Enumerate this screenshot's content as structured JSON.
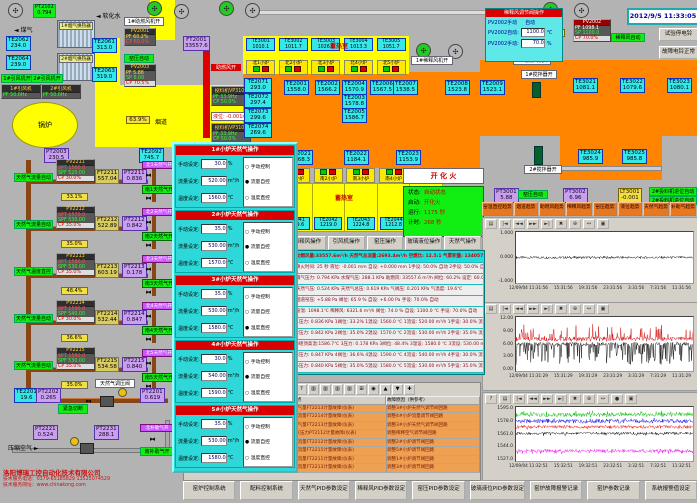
{
  "header": {
    "datetime": "2012/9/5 11:33:05"
  },
  "topLeft": {
    "gas": "煤气",
    "water": "软化水",
    "pt2102": [
      "PT2102",
      "0.794"
    ],
    "hx1": "1#烟气换热器",
    "hx2": "2#烟气换热器",
    "te2062": [
      "TE2062",
      "234.0"
    ],
    "te2061": [
      "TE2061",
      "313.0"
    ],
    "te2064": [
      "TE2064",
      "239.0"
    ],
    "te2063": [
      "TE2063",
      "319.0"
    ],
    "fan1open": "1#引风机开",
    "fan2open": "2#引风机开",
    "fan1name": "1#引风机",
    "fan1pf": "PF 50.0Hz",
    "fan2name": "2#引风机",
    "fan2pf": "PF 50.0Hz",
    "boiler": "锅炉",
    "flue": "烟道",
    "damper": "63.9%",
    "pt2003": [
      "PT2003",
      "230.5"
    ],
    "te2092": [
      "TE2092",
      "745.7"
    ],
    "ft2001": [
      "FT2001",
      "33557.6"
    ],
    "pv2001": {
      "tag": "PV2001",
      "r1": "PF 60.2%",
      "r2": "CP 60.0%"
    },
    "pv2003": {
      "tag": "PV2003",
      "r1": "PF 5.88",
      "r2": "SP 6.00",
      "r3": "CP 70.5%"
    },
    "yapAuto": "窑压自动",
    "combFan1": "1#助燃风机开",
    "combAirOpen": "助燃风开",
    "feeder1": {
      "tag": "投料机VP3101",
      "r1": "PF 33.9Hz",
      "r2": "CP 50.0%"
    },
    "feeder2": {
      "tag": "投料机VP3102",
      "r1": "PF 33.9Hz",
      "r2": "CP 50.0%"
    },
    "level": "液位: -0.001mm"
  },
  "north": {
    "label": "蓄热室",
    "chambers": [
      {
        "te": "TE3001",
        "v": "1010.1",
        "burner": "北1小炉"
      },
      {
        "te": "TE3002",
        "v": "1011.7",
        "burner": "北2小炉"
      },
      {
        "te": "TE3003",
        "v": "1026.1",
        "burner": "北3小炉"
      },
      {
        "te": "TE3004",
        "v": "1013.3",
        "burner": "北4小炉"
      },
      {
        "te": "TE3005",
        "v": "1051.7",
        "burner": "北5小炉"
      }
    ]
  },
  "south": {
    "label": "蓄热室",
    "chambers": [
      {
        "burner": "南1小炉",
        "te": "TE2041",
        "v": "1209.6"
      },
      {
        "burner": "南2小炉",
        "te": "TE2042",
        "v": "1219.0"
      },
      {
        "burner": "南3小炉",
        "te": "TE2043",
        "v": "1224.8"
      },
      {
        "burner": "南4小炉",
        "te": "TE2044",
        "v": "1212.8"
      },
      {
        "burner": "南5小炉",
        "te": "TE2045",
        "v": "1211.0"
      }
    ]
  },
  "furnaceTemps": {
    "te2071": [
      "TE2071",
      "293.0"
    ],
    "te2072": [
      "TE2072",
      "297.4"
    ],
    "te2073": [
      "TE2073",
      "299.6"
    ],
    "te2074": [
      "TE2074",
      "269.6"
    ],
    "te2001": [
      "TE2001",
      "1558.0"
    ],
    "te2002": [
      "TE2002",
      "1566.2"
    ],
    "te2003": [
      "TE2003",
      "1578.8"
    ],
    "te2004": [
      "TE2004",
      "1570.9"
    ],
    "te2005": [
      "TE2005",
      "1586.7"
    ],
    "te2006": [
      "TE2006",
      "1567.5"
    ],
    "te2007": [
      "TE2007",
      "1538.5"
    ],
    "te2008": [
      "TE2008",
      "1523.8"
    ],
    "te2009": [
      "TE2009",
      "1523.1"
    ],
    "te3021": [
      "TE3021",
      "1081.1"
    ],
    "te3022": [
      "TE3022",
      "1079.6"
    ],
    "te3023": [
      "TE3023",
      "1080.1"
    ],
    "te3024": [
      "TE3024",
      "985.9"
    ],
    "te3025": [
      "TE3025",
      "985.8"
    ],
    "te2021": [
      "TE2021",
      "1168.3"
    ],
    "te2022": [
      "TE2022",
      "1184.1"
    ],
    "te2023": [
      "TE2023",
      "1153.9"
    ]
  },
  "rightSide": {
    "dilPanel": {
      "title": "稀释风调节阀操作",
      "modeL": "PV2002手动",
      "modeR": "自动",
      "autoL": "PV2002自动:",
      "autoV": "1100.0",
      "autoU": "℃",
      "manL": "PV2002手动:",
      "manV": "70.0",
      "manU": "%"
    },
    "pct74": "74.0%",
    "pt2002": [
      "PT2002",
      "6321.6"
    ],
    "pv2002": {
      "tag": "PV2002",
      "r1": "PF 1098.1",
      "r2": "SP 1100.0",
      "r3": "CP 70.0%"
    },
    "dilAuto": "稀释风自动",
    "btnTest": "试验停电铃",
    "btnBell": "故障电铃正常",
    "dilFan1": "1#稀释风机开",
    "combFan2": "2#助燃风机开",
    "stir1": "1#搅拌器开",
    "stir2": "2#搅拌器开",
    "pt3001": [
      "PT3001",
      "5.88"
    ],
    "yapAuto2": "窑压自动",
    "pt3002": [
      "PT3002",
      "6.96"
    ],
    "lt3001": [
      "LT3001",
      "-0.001"
    ],
    "feederAuto1": "2#投料机进位自动",
    "feederAuto2": "2#投料机进位自动"
  },
  "ignition": "开 化 火",
  "status": {
    "rows": [
      {
        "k": "状态:",
        "v": "自动状态"
      },
      {
        "k": "启动:",
        "v": "开化火"
      },
      {
        "k": "运行:",
        "v": "1175 秒"
      },
      {
        "k": "计时:",
        "v": "268 秒"
      }
    ]
  },
  "opButtons": [
    "稀释风操作",
    "引风机操作",
    "窑压操作",
    "玻璃液位操作",
    "天然气操作"
  ],
  "trendButtons": [
    "窑温直控趋势",
    "烟道趋势",
    "助燃风趋势",
    "稀释风趋势",
    "窑压趋势",
    "液位趋势",
    "天然气趋势",
    "补助气趋势"
  ],
  "gasLoops": [
    {
      "auto": "天然气流量自动",
      "tag": "PV2211",
      "spt": "SPT 1560.0",
      "spf": "SPF 520.00",
      "cp": "CP 30.0%",
      "ft": "FT2211",
      "ftv": "557.04",
      "pt": "PT2211",
      "ptv": "0.836",
      "pct": "33.1%",
      "vN": "北1天然气开",
      "vS": "南1天然气开"
    },
    {
      "auto": "天然气流量自动",
      "tag": "PV2212",
      "spt": "SPT 1570.0",
      "spf": "SPF 530.00",
      "cp": "CP 35.0%",
      "ft": "FT2212",
      "ftv": "522.89",
      "pt": "PT2212",
      "ptv": "0.842",
      "pct": "35.0%",
      "vN": "北2天然气开",
      "vS": "南2天然气开"
    },
    {
      "auto": "天然气温度直控",
      "tag": "PV2213",
      "spt": "SPT 1580.0",
      "spf": "SPF 530.00",
      "cp": "CP 35.0%",
      "ft": "FT2213",
      "ftv": "603.19",
      "pt": "PT2213",
      "ptv": "0.178",
      "pct": "48.4%",
      "vN": "北3天然气开",
      "vS": "南3天然气开"
    },
    {
      "auto": "天然气流量自动",
      "tag": "PV2214",
      "spt": "SPT 1590.0",
      "spf": "SPF 540.00",
      "cp": "CP 30.0%",
      "ft": "FT2214",
      "ftv": "532.44",
      "pt": "PT2214",
      "ptv": "0.847",
      "pct": "36.6%",
      "vN": "北4天然气开",
      "vS": "南4天然气开"
    },
    {
      "auto": "天然气流量自动",
      "tag": "PV2215",
      "spt": "SPT 1580.0",
      "spf": "SPF 530.00",
      "cp": "CP 35.0%",
      "ft": "FT2215",
      "ftv": "534.58",
      "pt": "PT2215",
      "ptv": "0.840",
      "pct": "35.0%",
      "vN": "北5天然气开",
      "vS": "南5天然气开"
    }
  ],
  "bottomLeft": {
    "te2201": [
      "TE2201",
      "19.6"
    ],
    "pt2202": [
      "PT2202",
      "0.265"
    ],
    "btnCut": "紧急切断",
    "valveLabel": "天然气调压阀",
    "pt2201": [
      "PT2201",
      "0.619"
    ],
    "vN": "北补助气开",
    "vS": "南补助气开",
    "pt2221": [
      "PT2221",
      "0.524"
    ],
    "pt2231": [
      "PT2231",
      "288.1"
    ],
    "air": "压缩空气"
  },
  "popup": {
    "labels": {
      "manual": "手动设定:",
      "flow": "流量设定:",
      "temp": "温度设定:",
      "uM": "%",
      "uF": "m³/h",
      "uT": "℃",
      "rManual": "手动控制",
      "rFlow": "流量自控",
      "rTemp": "温度直控"
    },
    "sections": [
      {
        "title": "1#小炉天然气操作",
        "manual": "30.0",
        "flow": "520.00",
        "temp": "1560.0",
        "r1": "○",
        "r2": "●",
        "r3": "○"
      },
      {
        "title": "2#小炉天然气操作",
        "manual": "35.0",
        "flow": "530.00",
        "temp": "1570.0",
        "r1": "○",
        "r2": "●",
        "r3": "○"
      },
      {
        "title": "3#小炉天然气操作",
        "manual": "35.0",
        "flow": "530.00",
        "temp": "1580.0",
        "r1": "○",
        "r2": "○",
        "r3": "●"
      },
      {
        "title": "4#小炉天然气操作",
        "manual": "30.0",
        "flow": "540.00",
        "temp": "1590.0",
        "r1": "○",
        "r2": "●",
        "r3": "○"
      },
      {
        "title": "5#小炉天然气操作",
        "manual": "35.0",
        "flow": "530.00",
        "temp": "1580.0",
        "r1": "○",
        "r2": "●",
        "r3": "○"
      }
    ]
  },
  "params": {
    "rows": [
      "助燃风量:33557.6m³/h  天然气总流量:2693.4m³/h  空燃比: 12.5:1  气累积量: 134057.7m³",
      "换火时间: 25 秒   液位: -0.001 mm  自设: +0.000 mm  1手设: 50.0% 自动  2手设: 50.0% 自动",
      "煤气压力: 0.794 KPa  水煤气压: 288.1 KPa  助燃风: 33557.6 m³/h  阀位: 60.2%  设定: 60.0%",
      "天然气压: 0.524 KPa  天然气总压: 0.619 KPa  气阀压: 0.201 KPa  气温度: 19.6℃",
      "烟道窑压: +5.88 Pa  阀位: 65.9 %  自设: +6.00 Pa  手设: 70.0%  自动",
      "窑温: 1098.1℃  稀释风: 6321.6 m³/h  阀位: 74.0 %  自设: 1100.0 ℃  手设: 70.0%  自动",
      "1压力: 0.836 KPa  1阀位: 33.2%  1温设: 1560.0 ℃  1流设: 520.00 m³/h  1手设: 30.0%  流控",
      "2压力: 0.842 KPa  2阀位: 35.0%  2温设: 1570.0 ℃  2流设: 530.00 m³/h  2手设: 35.0%  流控",
      "3碹顶高温:1586.7℃  3压力: 0.178 KPa  3阀位: 48.4%  3温设: 1580.0 ℃  3流设: 530.00 m³/h  3手设: 35.0%  温控",
      "4压力: 0.847 KPa  4阀位: 36.6%  4温设: 1590.0 ℃  4流设: 540.00 m³/h  4手设: 30.0%  流控",
      "5压力: 0.840 KPa  5阀位: 35.0%  5温设: 1580.0 ℃  5流设: 530.00 m³/h  5手设: 35.0%  流控"
    ]
  },
  "log": {
    "toolbar": [
      "≣",
      "?",
      "▥",
      "▥",
      "▥",
      "▥",
      "⊞",
      "◉",
      "▲",
      "▼",
      "✚"
    ],
    "hFault": "故障点",
    "hReason": "故障原因（供参考）",
    "rows": [
      [
        "",
        "16",
        "98",
        "2012/09/05",
        "11:17:20",
        "3#小炉气量FT2213计量故障(仪表)",
        "调整3#小炉天然气调节阀回路"
      ],
      [
        "",
        "17",
        "84",
        "2012/09/05",
        "11:17:23",
        "4#小炉流量FT2214计量故障(仪表)",
        "调整4#小炉流量调节阀回路"
      ],
      [
        "",
        "18",
        "97",
        "2012/09/05",
        "11:17:26",
        "3#小炉气量FT2213计量故障(仪表)",
        "调整3#小炉天然气调节阀回路"
      ],
      [
        "",
        "19",
        "75",
        "2012/09/05",
        "11:17:30",
        "稀释空气压力PT2112计量故障(仪表)",
        "调整稀释空气调节阀回路"
      ],
      [
        "",
        "20",
        "82",
        "2012/09/05",
        "11:17:33",
        "2#小炉流量FT2212计量故障(仪表)",
        "调整2#小炉调节阀回路"
      ],
      [
        "",
        "21",
        "85",
        "2012/09/05",
        "11:17:33",
        "5#小炉流量FT2215计量故障(仪表)",
        "调整5#小炉调节阀回路"
      ],
      [
        "",
        "22",
        "81",
        "2012/09/05",
        "11:17:33",
        "1#小炉流量FT2211计量故障(仪表)",
        "调整1#小炉调节阀回路"
      ],
      [
        "▶",
        "23",
        "83",
        "2012/09/05",
        "11:17:33",
        "3#小炉流量FT2213计量故障(仪表)",
        "调整3#小炉调节阀回路"
      ]
    ]
  },
  "charts": {
    "toolbar": [
      "▤",
      "|◄",
      "◄◄",
      "►►",
      "►|",
      "✖",
      "⊕",
      "↔",
      "▣"
    ],
    "toolbar3": [
      "?",
      "▤",
      "|◄",
      "◄◄",
      "►►",
      "►|",
      "✖",
      "⊕",
      "↔",
      "●",
      "▣"
    ]
  },
  "chart_data": [
    {
      "type": "line",
      "title": "液位趋势",
      "yTicks": [
        "1.000",
        "0.000",
        "-1.000"
      ],
      "ymin": -1,
      "ymax": 1,
      "xTicks": [
        "12/09/04 11:31:56",
        "15:31:56",
        "19:31:56",
        "23:31:56",
        "3:31:56",
        "7:31:56",
        "11:31:56"
      ],
      "series": [
        {
          "name": "液位 mm",
          "color": "#000000",
          "base": 0,
          "amp": 0.05,
          "p": 0,
          "spike": 0,
          "sdir": 1
        }
      ]
    },
    {
      "type": "line",
      "title": "窑压趋势",
      "yTicks": [
        "12.00",
        "9.00",
        "6.00",
        "3.00",
        "0.00"
      ],
      "ymin": 0,
      "ymax": 12,
      "xTicks": [
        "12/09/04 11:31:29",
        "15:31:29",
        "19:31:29",
        "23:31:29",
        "3:31:29",
        "7:31:29",
        "11:31:29"
      ],
      "series": [
        {
          "name": "窑压设定 Pa",
          "color": "#cc0000",
          "base": 7.1,
          "amp": 0.5,
          "p": 0.18,
          "spike": 3.0,
          "sdir": 1
        },
        {
          "name": "窑压 Pa",
          "color": "#000000",
          "base": 6.0,
          "amp": 0.4,
          "p": 0.28,
          "spike": 4.5,
          "sdir": -1
        }
      ]
    },
    {
      "type": "line",
      "title": "窑温趋势",
      "yTicks": [
        "1595.0",
        "1578.0",
        "1561.0",
        "1544.0",
        "1527.0"
      ],
      "ymin": 1527,
      "ymax": 1595,
      "xTicks": [
        "12/09/04 11:32:51",
        "15:32:51",
        "19:32:51",
        "23:32:51",
        "3:32:51",
        "7:32:51",
        "11:32:51"
      ],
      "series": [
        {
          "name": "5#窑温",
          "color": "#00bb00",
          "base": 1585,
          "amp": 2.5,
          "p": 0.3,
          "spike": 3,
          "sdir": 1
        },
        {
          "name": "4#窑温",
          "color": "#0000ee",
          "base": 1577,
          "amp": 2.5,
          "p": 0.2,
          "spike": 2,
          "sdir": 1
        },
        {
          "name": "3#窑温",
          "color": "#ee0000",
          "base": 1570,
          "amp": 2.0,
          "p": 0.15,
          "spike": 2,
          "sdir": -1
        },
        {
          "name": "2#窑温",
          "color": "#000000",
          "base": 1562,
          "amp": 1.5,
          "p": 0.2,
          "spike": 2,
          "sdir": -1
        },
        {
          "name": "1#窑温",
          "color": "#ee00ee",
          "base": 1540,
          "amp": 2.0,
          "p": 0.3,
          "spike": 3,
          "sdir": -1
        }
      ]
    }
  ],
  "bottomButtons": [
    "窑炉控制系统",
    "配料控制系统",
    "天然气PID参数设定",
    "稀释风PID参数设定",
    "窑压PID参数设定",
    "玻璃液位PID参数设定",
    "窑炉故障报警记录",
    "窑炉参数记录",
    "系统报警值设定"
  ],
  "company": {
    "l1": "洛阳博瑞工控自动化技术有限公司",
    "l2": "技术服务电话：0379-65185829  13525074529",
    "l3": "技术服务网址：www.chinakong.com"
  }
}
